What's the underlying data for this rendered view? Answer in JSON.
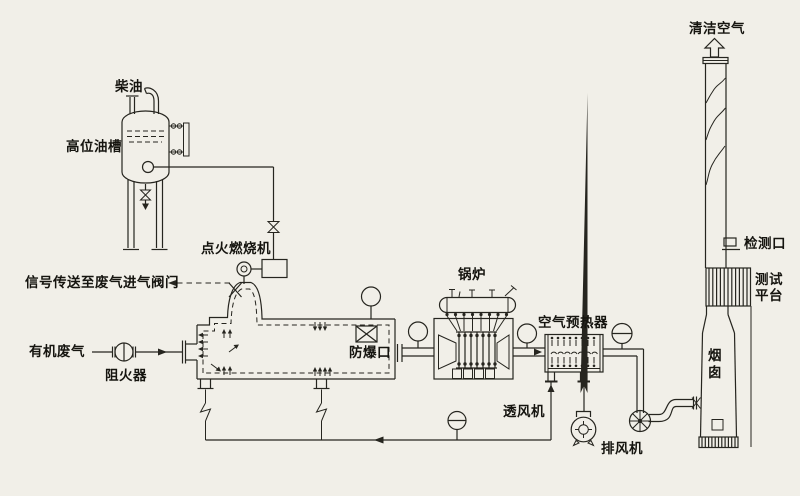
{
  "diagram": {
    "title": "有机废气焚烧处理系统流程图",
    "labels": {
      "diesel": "柴油",
      "oil_tank": "高位油槽",
      "ignition_burner": "点火燃烧机",
      "signal": "信号传送至废气进气阀门",
      "organic_waste_gas": "有机废气",
      "flame_arrester": "阻火器",
      "explosion_vent": "防爆口",
      "boiler": "锅炉",
      "air_preheater": "空气预热器",
      "ventilation_fan": "透风机",
      "exhaust_fan": "排风机",
      "clean_air": "清洁空气",
      "detection_port": "检测口",
      "test_platform": "测试平台",
      "chimney": "烟囱"
    }
  },
  "colors": {
    "ink": "#26251f",
    "paper": "#f1efe8"
  }
}
